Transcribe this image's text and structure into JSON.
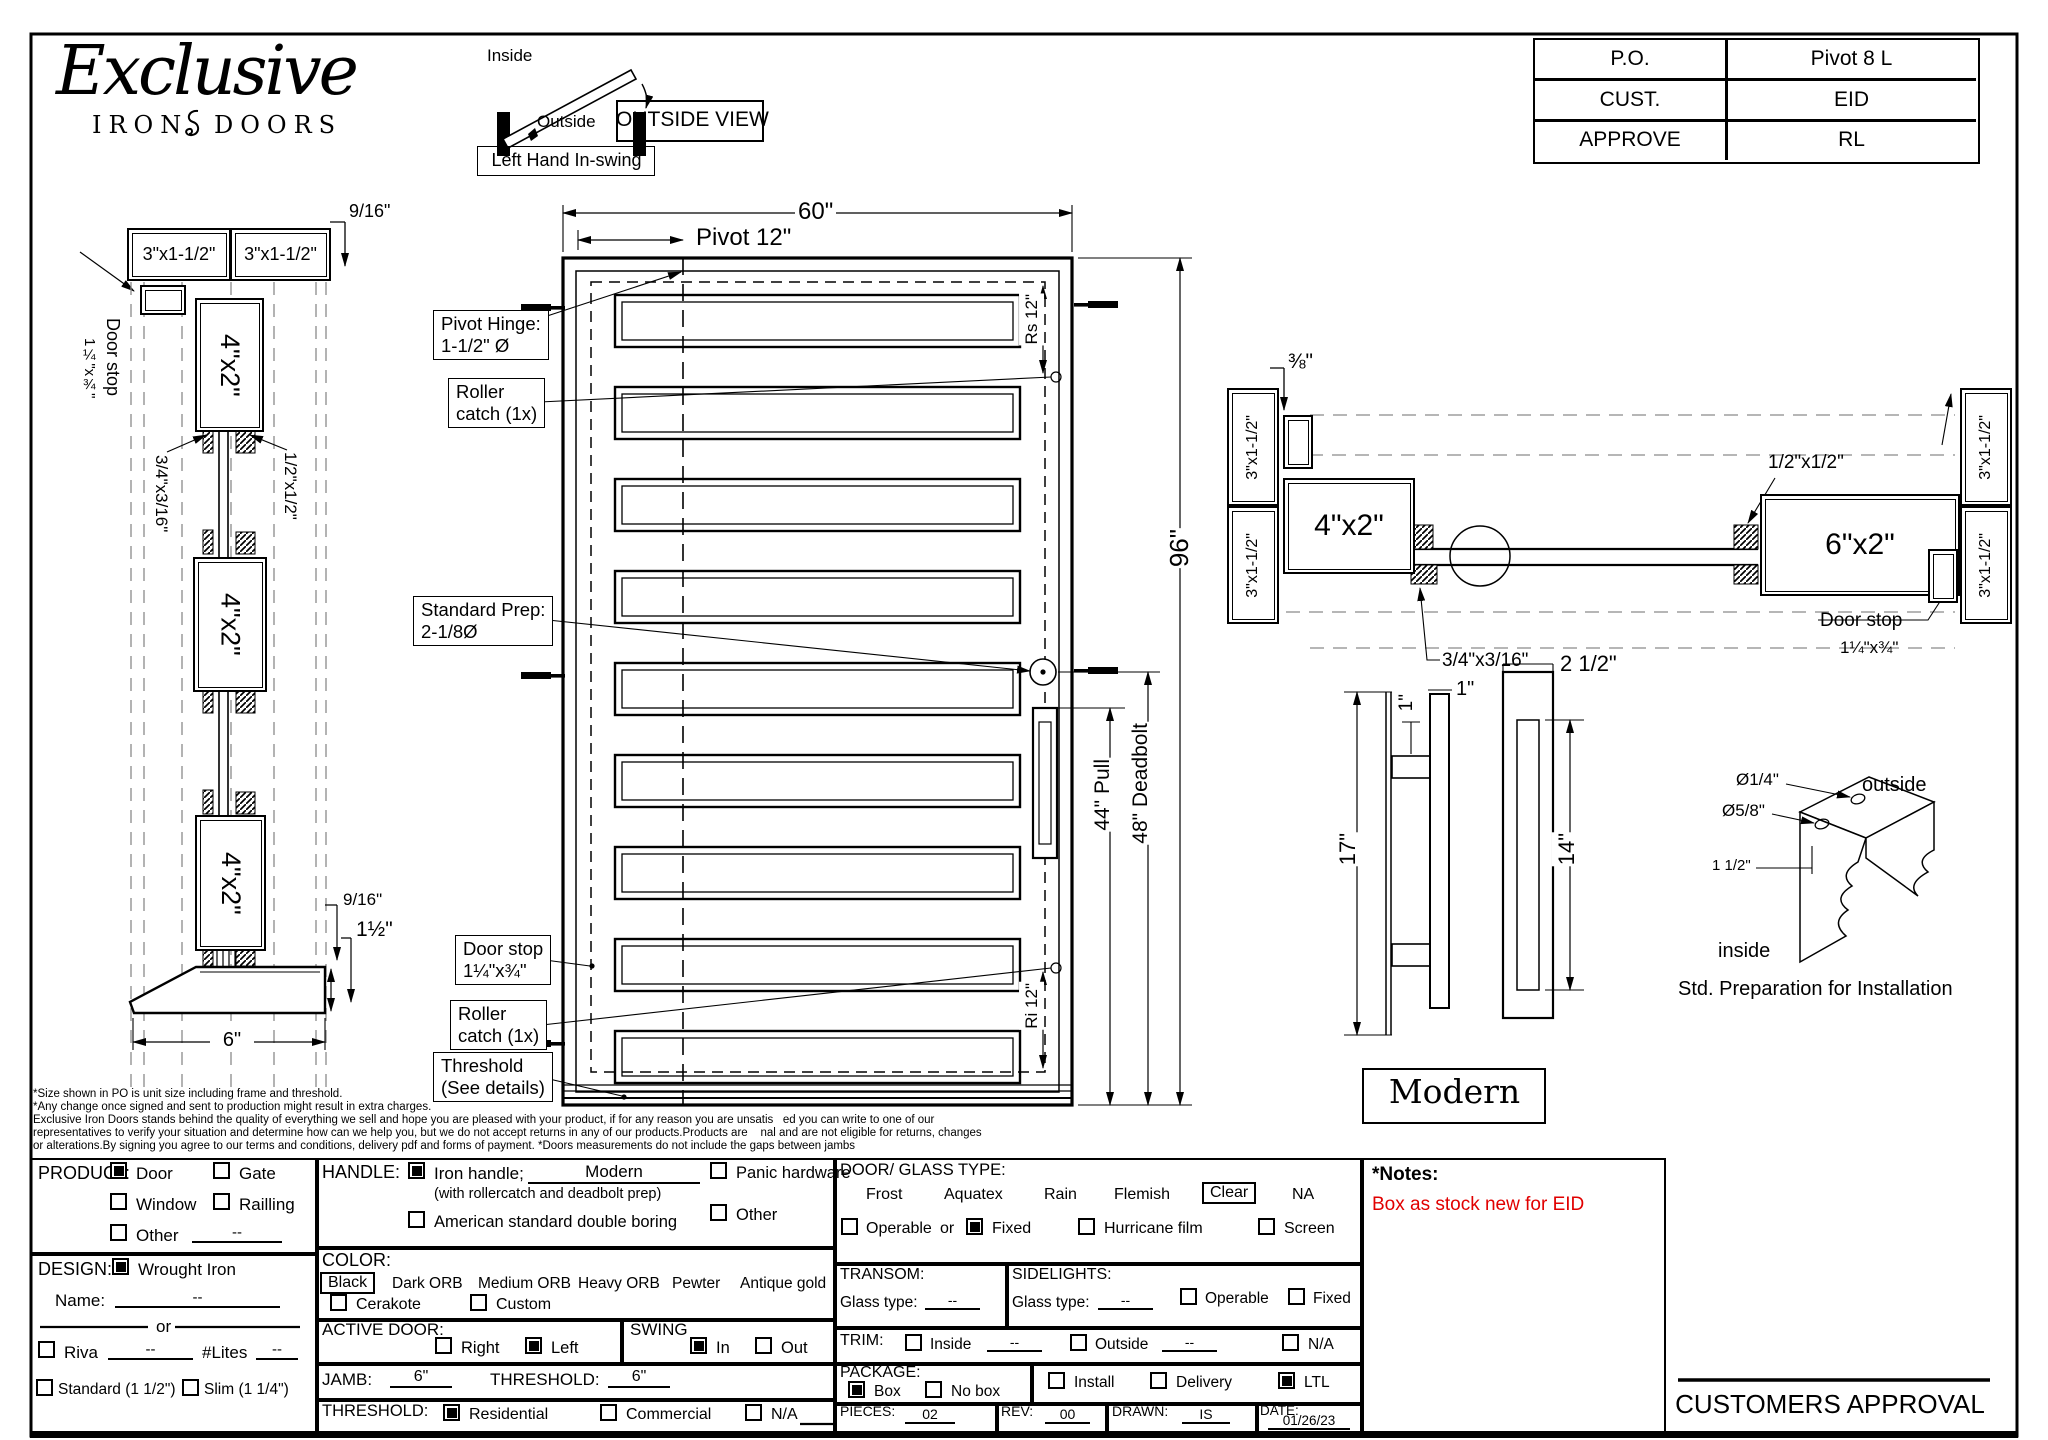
{
  "company": {
    "script": "Exclusive",
    "sub1": "IRON",
    "sub2": "DOORS"
  },
  "swing": {
    "inside": "Inside",
    "outside": "Outside",
    "label": "Left Hand In-swing"
  },
  "view_label": "OUTSIDE VIEW",
  "title_block": {
    "rows": [
      {
        "k": "P.O.",
        "v": "Pivot 8 L"
      },
      {
        "k": "CUST.",
        "v": "EID"
      },
      {
        "k": "APPROVE",
        "v": "RL"
      }
    ]
  },
  "left_section": {
    "dim_top": "9/16\"",
    "jamb": "3\"x1-1/2\"",
    "door_stop1": "Door stop",
    "door_stop2": "1¼\"x¾\"",
    "tube": "4\"x2\"",
    "lbl_34": "3/4\"x3/16\"",
    "lbl_12": "1/2\"x1/2\"",
    "dim_916": "9/16\"",
    "dim_15": "1½\"",
    "dim_6": "6\""
  },
  "door": {
    "dim_width": "60\"",
    "dim_pivot": "Pivot 12\"",
    "dim_rs": "Rs 12\"",
    "dim_ri": "Ri 12\"",
    "dim_height": "96\"",
    "dim_pull": "44\" Pull",
    "dim_deadbolt": "48\" Deadbolt",
    "callouts": {
      "pivot_hinge": [
        "Pivot Hinge:",
        "1-1/2\" Ø"
      ],
      "roller_top": [
        "Roller",
        "catch (1x)"
      ],
      "std_prep": [
        "Standard Prep:",
        "2-1/8Ø"
      ],
      "door_stop": [
        "Door stop",
        "1¼\"x¾\""
      ],
      "roller_bottom": [
        "Roller",
        "catch (1x)"
      ],
      "threshold": [
        "Threshold",
        "(See details)"
      ]
    }
  },
  "right_section": {
    "dim_38": "⅜\"",
    "jamb": "3\"x1-1/2\"",
    "tube4": "4\"x2\"",
    "tube6": "6\"x2\"",
    "lbl_12": "1/2\"x1/2\"",
    "lbl_34": "3/4\"x3/16\"",
    "door_stop1": "Door stop",
    "door_stop2": "1¼\"x¾\""
  },
  "handle": {
    "dim_1a": "1\"",
    "dim_1b": "1\"",
    "dim_17": "17\"",
    "dim_25": "2 1/2\"",
    "dim_14": "14\"",
    "style": "Modern"
  },
  "install": {
    "d1": "Ø1/4\"",
    "d2": "Ø5/8\"",
    "outside": "outside",
    "d3": "1 1/2\"",
    "inside": "inside",
    "caption": "Std. Preparation for Installation"
  },
  "disclaimer": [
    "*Size shown in PO is unit size including frame and threshold.",
    "*Any change once signed and sent to production might result in extra charges.",
    "Exclusive Iron Doors stands behind the quality of everything we sell and hope you are pleased with your product, if for any reason you are unsatis   ed you can write to one of our",
    "representatives to verify your situation and determine how can we help you, but we do not accept returns in any of our products.Products are    nal and are not eligible for returns, changes",
    "or alterations.By signing you agree to our terms and conditions, delivery pdf and forms of payment. *Doors measurements do not include the gaps between jambs"
  ],
  "form": {
    "product": {
      "label": "PRODUCT:",
      "door": "Door",
      "gate": "Gate",
      "window": "Window",
      "railing": "Railling",
      "other": "Other",
      "other_v": "--",
      "door_c": true,
      "gate_c": false,
      "window_c": false,
      "railing_c": false,
      "other_c": false
    },
    "design": {
      "label": "DESIGN:",
      "wrought": "Wrought Iron",
      "wrought_c": true,
      "name_label": "Name:",
      "name_v": "--",
      "or": "or",
      "riva": "Riva",
      "riva_c": false,
      "riva_v": "--",
      "lites": "#Lites",
      "lites_v": "--",
      "standard": "Standard (1 1/2\")",
      "standard_c": false,
      "slim": "Slim (1 1/4\")",
      "slim_c": false
    },
    "handle": {
      "label": "HANDLE:",
      "iron": "Iron handle;",
      "iron_c": true,
      "iron_v": "Modern",
      "note": "(with rollercatch and deadbolt prep)",
      "american": "American standard double boring",
      "american_c": false,
      "panic": "Panic hardware",
      "panic_c": false,
      "other": "Other",
      "other_c": false
    },
    "color": {
      "label": "COLOR:",
      "selected": "Black",
      "o1": "Dark ORB",
      "o2": "Medium ORB",
      "o3": "Heavy ORB",
      "o4": "Pewter",
      "o5": "Antique gold",
      "cerakote": "Cerakote",
      "cerakote_c": false,
      "custom": "Custom",
      "custom_c": false
    },
    "active": {
      "label": "ACTIVE DOOR:",
      "right": "Right",
      "right_c": false,
      "left": "Left",
      "left_c": true
    },
    "swing": {
      "label": "SWING",
      "in": "In",
      "in_c": true,
      "out": "Out",
      "out_c": false
    },
    "jamb": {
      "label": "JAMB:",
      "value": "6\"",
      "t_label": "THRESHOLD:",
      "t_value": "6\""
    },
    "threshold": {
      "label": "THRESHOLD:",
      "res": "Residential",
      "res_c": true,
      "com": "Commercial",
      "com_c": false,
      "na": "N/A",
      "na_c": false
    },
    "glass": {
      "label": "DOOR/ GLASS TYPE:",
      "t1": "Frost",
      "t2": "Aquatex",
      "t3": "Rain",
      "t4": "Flemish",
      "selected": "Clear",
      "t5": "NA",
      "operable": "Operable",
      "operable_c": false,
      "or": "or",
      "fixed": "Fixed",
      "fixed_c": true,
      "hurricane": "Hurricane film",
      "hurricane_c": false,
      "screen": "Screen",
      "screen_c": false
    },
    "transom": {
      "label": "TRANSOM:",
      "glass_label": "Glass type:",
      "value": "--"
    },
    "sidelights": {
      "label": "SIDELIGHTS:",
      "glass_label": "Glass type:",
      "value": "--",
      "operable": "Operable",
      "operable_c": false,
      "fixed": "Fixed",
      "fixed_c": false
    },
    "trim": {
      "label": "TRIM:",
      "inside": "Inside",
      "inside_c": false,
      "inside_v": "--",
      "outside": "Outside",
      "outside_c": false,
      "outside_v": "--",
      "na": "N/A",
      "na_c": false
    },
    "package": {
      "label": "PACKAGE:",
      "box": "Box",
      "box_c": true,
      "nobox": "No box",
      "nobox_c": false,
      "install": "Install",
      "install_c": false,
      "delivery": "Delivery",
      "delivery_c": false,
      "ltl": "LTL",
      "ltl_c": true
    },
    "meta": {
      "pieces_label": "PIECES:",
      "pieces": "02",
      "rev_label": "REV:",
      "rev": "00",
      "drawn_label": "DRAWN:",
      "drawn": "IS",
      "date_label": "DATE:",
      "date": "01/26/23"
    },
    "notes": {
      "label": "*Notes:",
      "value": "Box as stock new for EID",
      "color": "#e10000"
    }
  },
  "approval": "CUSTOMERS APPROVAL"
}
